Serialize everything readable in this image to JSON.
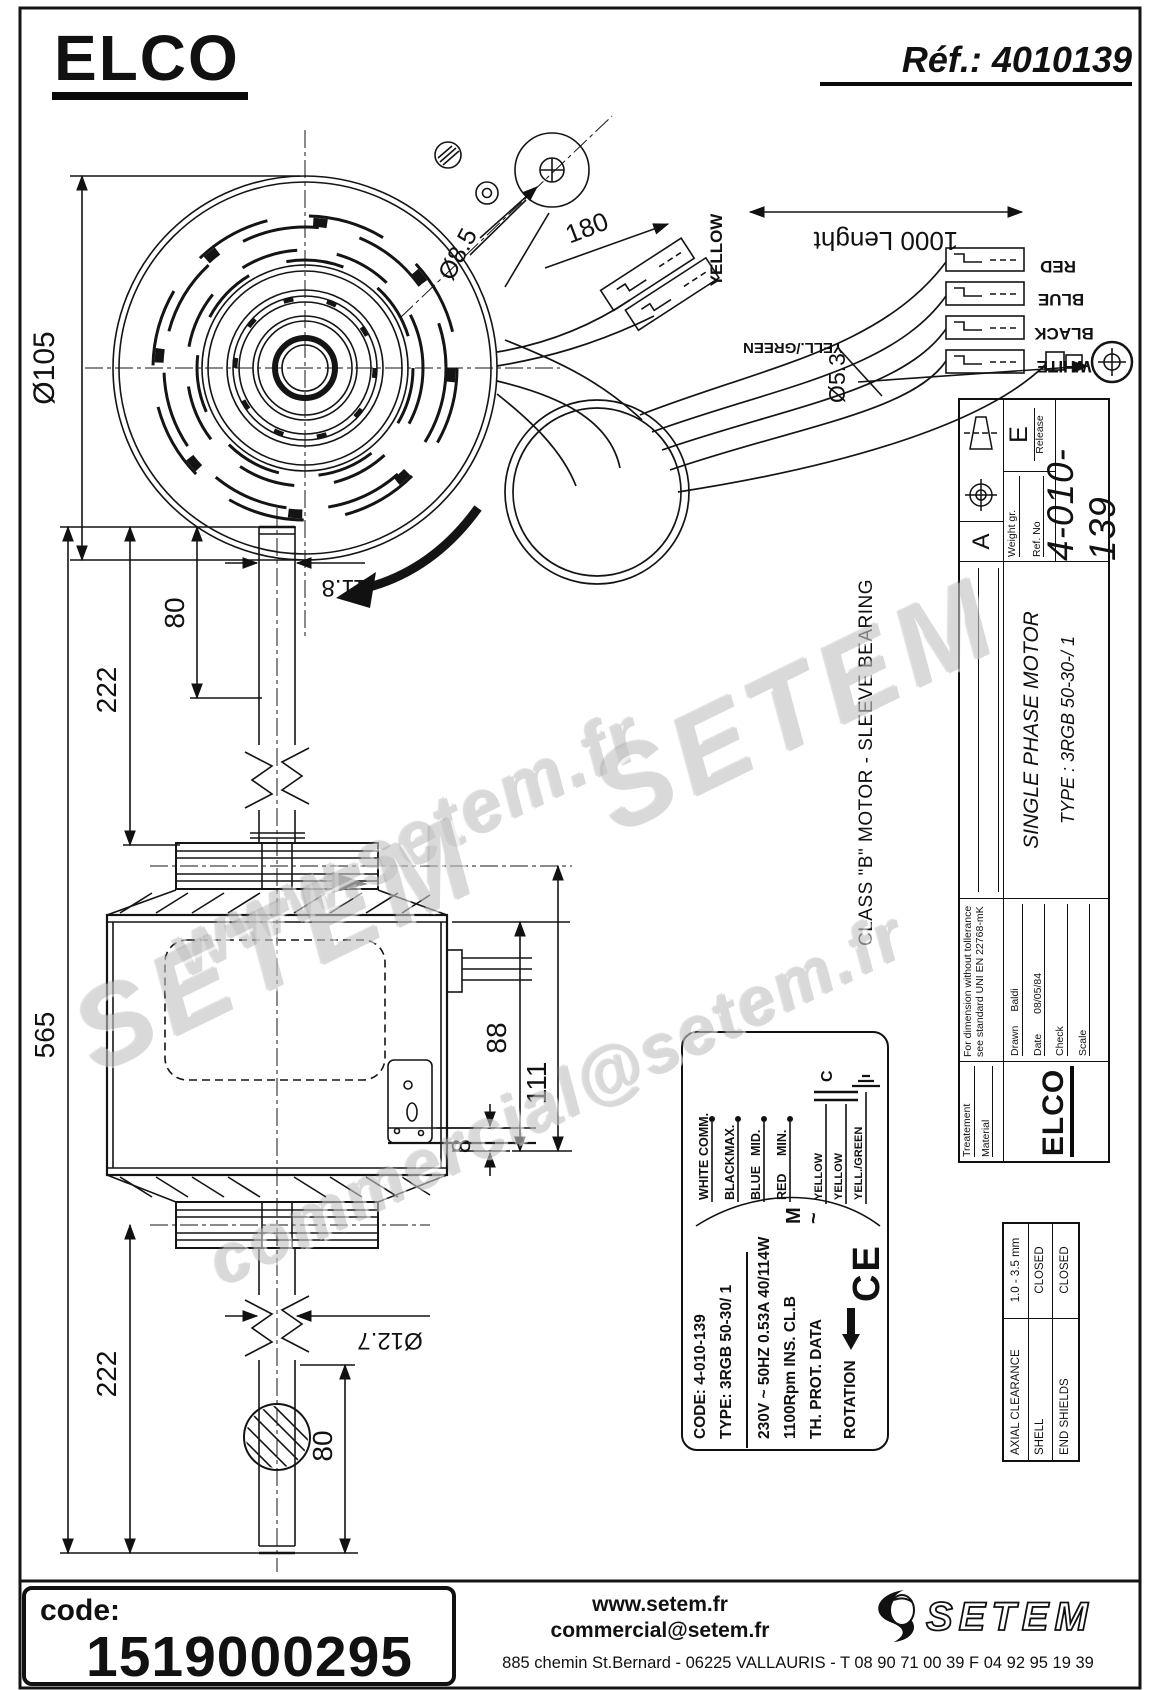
{
  "page": {
    "brand": "ELCO",
    "ref_label": "Réf.: 4010139"
  },
  "drawing": {
    "dims": {
      "d105": "Ø105",
      "d85": "Ø8.5",
      "d180": "180",
      "d1000": "1000  Lenght",
      "d53": "Ø5.3",
      "d118": "11.8",
      "d80_top": "80",
      "d222_top": "222",
      "d565": "565",
      "d88": "88",
      "d111": "111",
      "d8": "8",
      "d127": "Ø12.7",
      "d222_bottom": "222",
      "d80_bottom": "80"
    },
    "wire_labels": {
      "yellow": "YELLOW",
      "red": "RED",
      "blue": "BLUE",
      "black": "BLACK",
      "white": "WHITE",
      "yellgreen": "YELL./GREEN"
    }
  },
  "titleblock": {
    "treatement": "Treatement",
    "material": "Material",
    "tolerance_note_1": "For dimension without tollerance",
    "tolerance_note_2": "see standard UNI EN 22768-mK",
    "drawn_label": "Drawn",
    "drawn_value": "Baldi",
    "date_label": "Date",
    "date_value": "08/05/84",
    "check_label": "Check",
    "scale_label": "Scale",
    "weight_label": "Weight gr.",
    "refno_label": "Ref. No",
    "release_label": "Release",
    "release_value": "E",
    "view_letter": "A",
    "title": "SINGLE PHASE MOTOR",
    "type_line": "TYPE : 3RGB  50-30-/ 1",
    "drawing_no": "4-010-139",
    "class_note": "CLASS \"B\"  MOTOR   -   SLEEVE BEARING",
    "brand": "ELCO"
  },
  "spec_table": {
    "rows": [
      {
        "label": "AXIAL CLEARANCE",
        "value": "1.0 - 3.5 mm"
      },
      {
        "label": "SHELL",
        "value": "CLOSED"
      },
      {
        "label": "END SHIELDS",
        "value": "CLOSED"
      }
    ]
  },
  "nameplate": {
    "code_line": "CODE:  4-010-139",
    "type_line": "TYPE:  3RGB 50-30/ 1",
    "power_line": "230V ~  50HZ  0.53A   40/114W",
    "rpm_line": "1100Rpm   INS. CL.B",
    "th_line": "TH. PROT.    DATA",
    "rotation_label": "ROTATION",
    "ce_mark": "CE",
    "motor_m": "M",
    "motor_tilde": "~",
    "cap_label": "C",
    "wires": [
      {
        "color": "WHITE",
        "function": "COMM."
      },
      {
        "color": "BLACK",
        "function": "MAX."
      },
      {
        "color": "BLUE",
        "function": "MID."
      },
      {
        "color": "RED",
        "function": "MIN."
      }
    ],
    "cap_wires": [
      "YELLOW",
      "YELLOW",
      "YELL./GREEN"
    ]
  },
  "watermarks": {
    "wm1": "www.setem.fr",
    "wm2": "SETEM",
    "wm3": "SETEM",
    "wm4": "commercial@setem.fr"
  },
  "footer": {
    "code_label": "code:",
    "code_value": "1519000295",
    "site": "www.setem.fr",
    "email": "commercial@setem.fr",
    "address": "885 chemin St.Bernard  -  06225 VALLAURIS  -  T 08 90 71 00 39   F 04 92 95 19 39",
    "logo_text": "SETEM"
  }
}
